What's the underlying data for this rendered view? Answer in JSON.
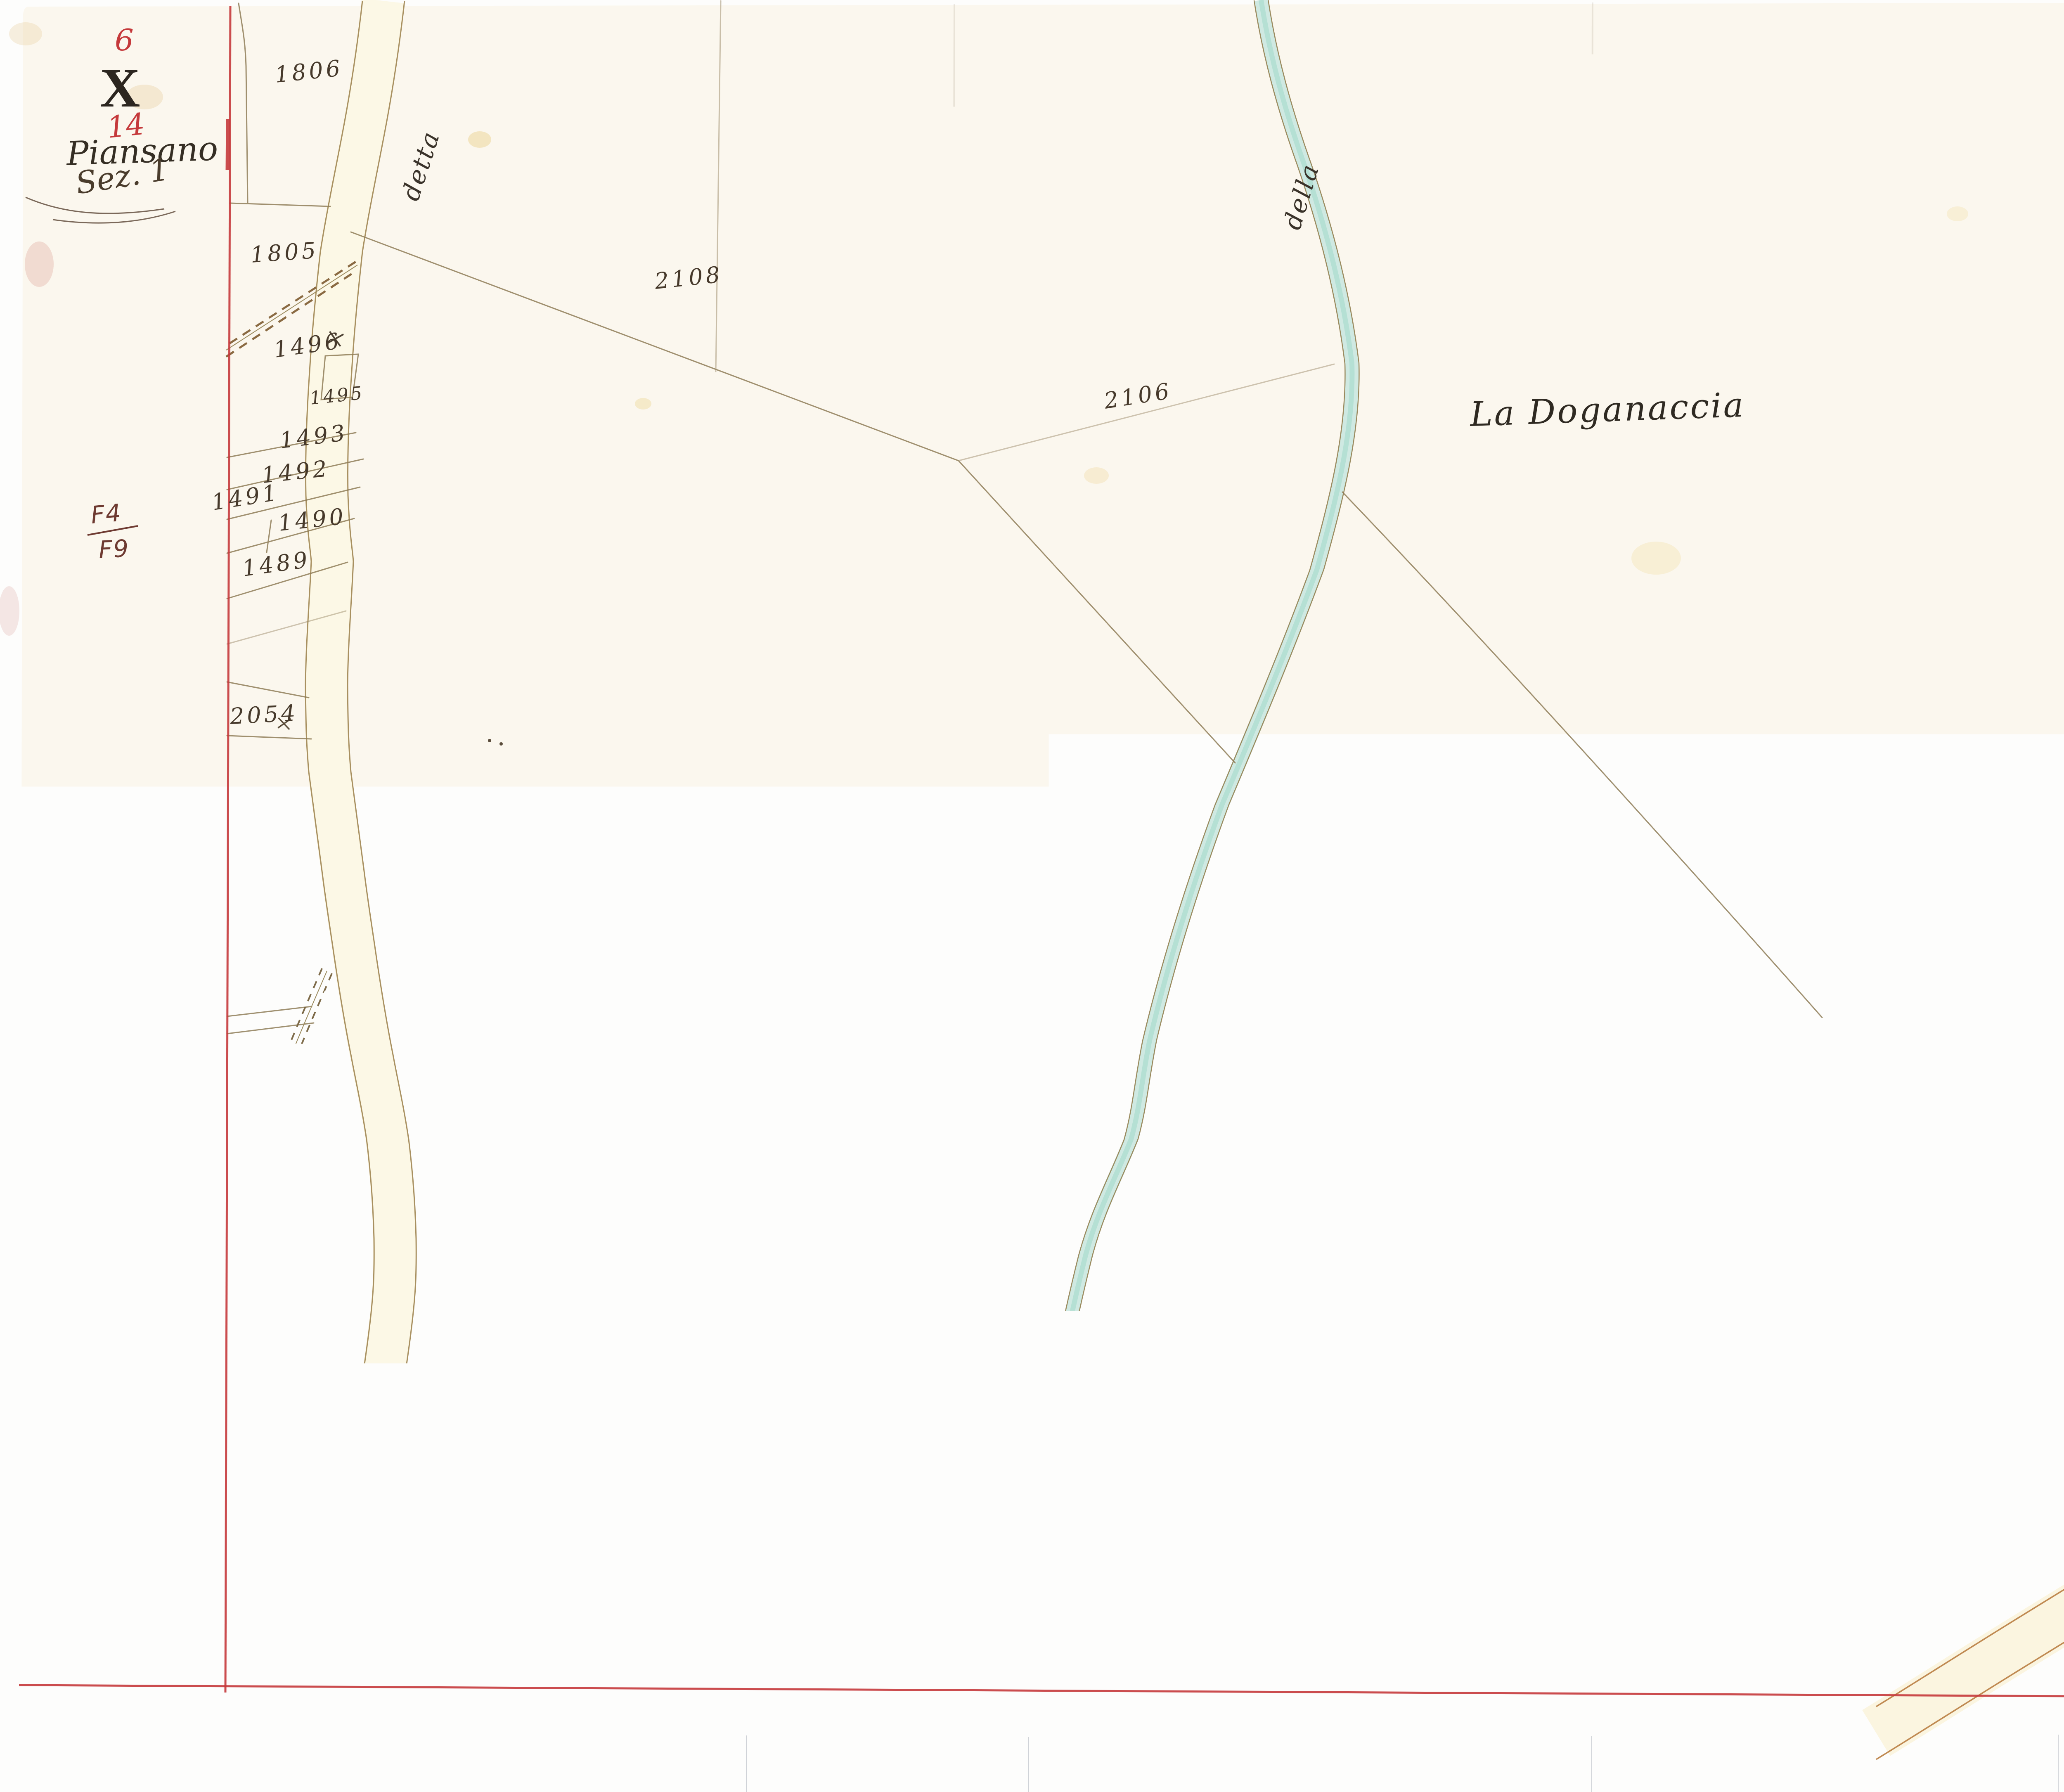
{
  "corner_annotations": {
    "folio_number": "6",
    "series": "X",
    "sheet_number": "14",
    "commune": "Piansano",
    "section": "Sez. 1",
    "reference_upper": "F4",
    "reference_lower": "F9"
  },
  "place_labels": {
    "region": "La Doganaccia",
    "bottom_right_road": "Capodimonte"
  },
  "road_labels": {
    "left_road_top": "detta",
    "left_road_bottom": "Doganale"
  },
  "stream_labels": {
    "top": "della",
    "bottom": "detto"
  },
  "parcel_numbers": {
    "p1806": "1806",
    "p1805": "1805",
    "p1496": "1496",
    "p1495": "1495",
    "p1493": "1493",
    "p1492": "1492",
    "p1491": "1491",
    "p1490": "1490",
    "p1489": "1489",
    "p2054": "2054",
    "p1475": "1475",
    "p1473": "1473",
    "p1474": "1474",
    "p1467": "1467",
    "p1316": "1316",
    "p2128": "2128",
    "p2108": "2108",
    "p2106": "2106",
    "p2107": "2107",
    "p1959": "1959",
    "p2105": "2105",
    "p1823": "1823"
  },
  "pencil_numbers": {
    "p1485": "1485",
    "p1463": "1463"
  },
  "colors": {
    "neat_line_red": "#c5393b",
    "ink": "#46392b",
    "pencil": "#b7afa0",
    "stream_fill": "#cfe9e2",
    "road_fill": "#fcf8e6",
    "road_edge": "#a89060",
    "capodimonte_road_edge": "#c08a52",
    "paper": "#fbf7ee",
    "margin_paper": "#f7eed6",
    "reference_ink": "#6e3a31",
    "blue_mark": "#3b55a0"
  }
}
